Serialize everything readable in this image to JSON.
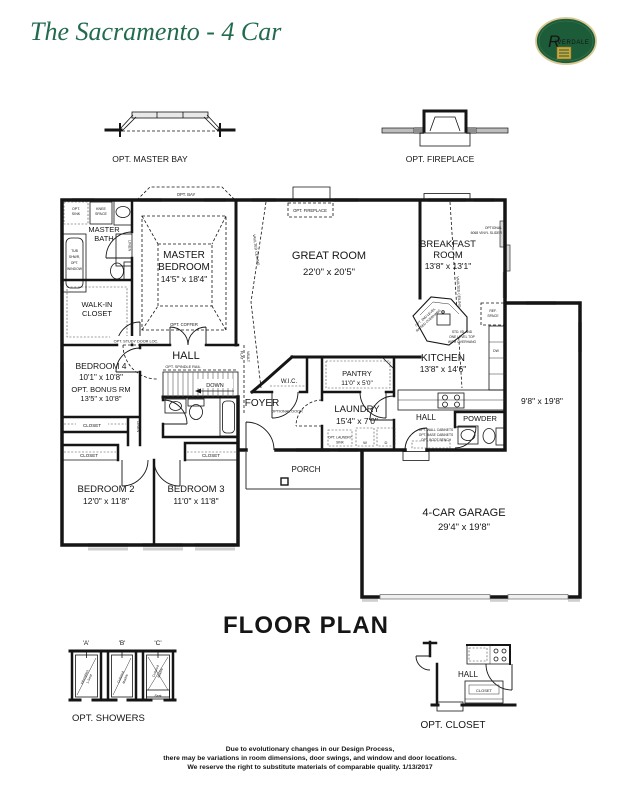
{
  "header": {
    "title": "The Sacramento - 4 Car",
    "logo_r": "R",
    "logo_rest": "IVERDALE"
  },
  "top_details": {
    "master_bay": "OPT. MASTER BAY",
    "fireplace": "OPT. FIREPLACE"
  },
  "rooms": {
    "master_bath_1": "MASTER",
    "master_bath_2": "BATH",
    "master_bedroom_1": "MASTER",
    "master_bedroom_2": "BEDROOM",
    "master_bedroom_dims": "14'5\" x 18'4\"",
    "walk_in_1": "WALK-IN",
    "walk_in_2": "CLOSET",
    "bedroom4": "BEDROOM 4",
    "bedroom4_dims": "10'1\" x 10'8\"",
    "bonus": "OPT. BONUS RM",
    "bonus_dims": "13'5\" x 10'8\"",
    "hall": "HALL",
    "bedroom2": "BEDROOM 2",
    "bedroom2_dims": "12'0\" x 11'8\"",
    "bedroom3": "BEDROOM 3",
    "bedroom3_dims": "11'0\" x 11'8\"",
    "foyer": "FOYER",
    "wic": "W.I.C.",
    "pantry": "PANTRY",
    "pantry_dims": "11'0\" x 5'0\"",
    "laundry": "LAUNDRY",
    "laundry_dims": "15'4\" x 7'0\"",
    "great_room": "GREAT ROOM",
    "great_room_dims": "22'0\" x 20'5\"",
    "breakfast_1": "BREAKFAST",
    "breakfast_2": "ROOM",
    "breakfast_dims": "13'8\" x 13'1\"",
    "kitchen": "KITCHEN",
    "kitchen_dims": "13'8\" x 14'6\"",
    "rear_hall": "HALL",
    "powder": "POWDER",
    "garage": "4-CAR GARAGE",
    "garage_dims": "29'4\" x 19'8\"",
    "bay_dims": "9'8\" x 19'8\"",
    "porch": "PORCH",
    "closet": "CLOSET",
    "linen": "LINEN"
  },
  "annotations": {
    "opt_bay": "OPT. BAY",
    "opt_fireplace": "OPT. FIREPLACE",
    "opt_coffer": "OPT. COFFER",
    "opt_sink_1": "OPT.",
    "opt_sink_2": "SINK",
    "knee_1": "KNEE",
    "knee_2": "SPACE",
    "tub_1": "TUB",
    "tub_2": "SHWR,",
    "tub_3": "OPT.",
    "tub_4": "WINDOW",
    "opt_study_door": "OPT. STUDY DOOR LOC.",
    "opt_spindle_rail": "OPT. SPINDLE RAIL",
    "down": "DOWN",
    "flat_vault_1": "FLAT",
    "flat_vault_2": "VAULT",
    "vaulted_ceiling": "VAULTED CEILING",
    "optional_door": "OPTIONAL DOOR",
    "opt_laundry_sink_1": "OPT. LAUNDRY",
    "opt_laundry_sink_2": "SINK",
    "washer": "W",
    "dryer": "D",
    "opt_wall_cabinets": "OPT. WALL CABINETS",
    "opt_base_cabinets": "OPT. BASE CABINETS",
    "opt_boot_bench": "OPT. BOOT BENCH",
    "optional_slider_1": "OPTIONAL",
    "optional_slider_2": "6068 VINYL SLIDER",
    "ref_1": "REF.",
    "ref_2": "SPACE",
    "dw": "DW",
    "std_island_1": "STD. ISLAND",
    "std_island_2": "ONE LEVEL TOP",
    "std_island_3": "WITH OVERHANG",
    "opt_2nd_1": "OPT. 2ND LEVEL",
    "opt_2nd_2": "RAISED OVERHANG"
  },
  "footer": {
    "floor_plan": "FLOOR PLAN",
    "showers_label": "OPT. SHOWERS",
    "shower_a": "'A'",
    "shower_b": "'B'",
    "shower_c": "'C'",
    "shower_a_type_1": "Fiberglass",
    "shower_a_type_2": "1-Seat",
    "shower_bc_type_1": "Cultured",
    "shower_bc_type_2": "Marble",
    "shower_c_seat": "Seat",
    "closet_label": "OPT. CLOSET",
    "closet_hall": "HALL",
    "closet_closet": "CLOSET",
    "disclaimer_1": "Due to evolutionary changes in our Design Process,",
    "disclaimer_2": "there may be variations in room dimensions, door swings, and window and door locations.",
    "disclaimer_3": "We reserve the right to substitute materials of comparable quality. 1/13/2017"
  },
  "colors": {
    "brand_green": "#1d5c38",
    "logo_gold": "#c9a73f",
    "window_gray": "#a9a9a9"
  }
}
